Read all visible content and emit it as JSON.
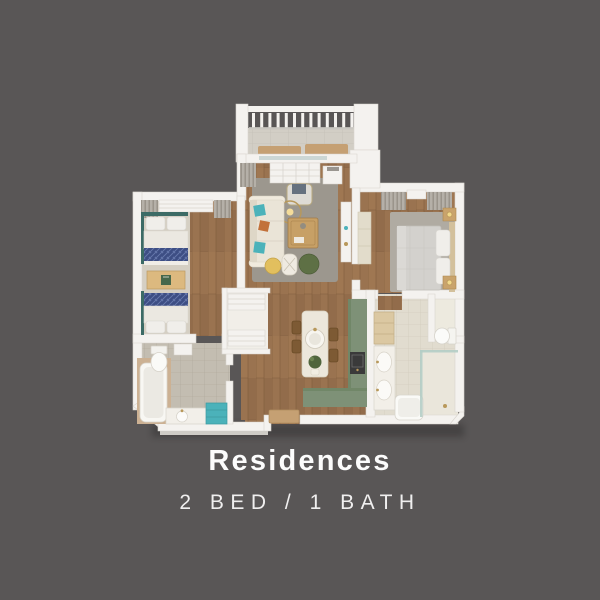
{
  "card": {
    "width": 600,
    "height": 600
  },
  "footer": {
    "title": "Residences",
    "subtitle": "2 BED / 1 BATH"
  },
  "floorplan_rooms": [
    "balcony",
    "living-room",
    "bedroom-secondary",
    "bedroom-primary",
    "kitchen",
    "bathroom-left",
    "bathroom-right",
    "walk-in-closet",
    "entry"
  ],
  "palette": {
    "bg": "#595656",
    "wall": "#f4f2ef",
    "wallEdge": "#d8d4ce",
    "wallFace": "#cfccc6",
    "wood": "#9a7350",
    "woodLine": "#7d5a3b",
    "woodLight": "#b08457",
    "rug": "#9c978e",
    "carpet": "#d5cfc3",
    "sofa": "#eae4d7",
    "teal": "#4bb2ba",
    "tealDark": "#3c6b66",
    "navy": "#3d4e84",
    "navyLight": "#7284b8",
    "sage": "#7e9177",
    "sageEdge": "#69805f",
    "island": "#ece7db",
    "concrete": "#d2cec5",
    "tileA": "#c3bdb1",
    "tileB": "#e1dccf",
    "tan": "#c5a073",
    "bedGray": "#d3d1cd",
    "pillow": "#f0eeea",
    "greenPouf": "#5e7045",
    "yellow": "#e2bf5e",
    "orange": "#c2713a",
    "gold": "#b8985a",
    "tableWood": "#c7a066",
    "drape": "#b5b0a8",
    "appliance": "#3a3a3a"
  }
}
